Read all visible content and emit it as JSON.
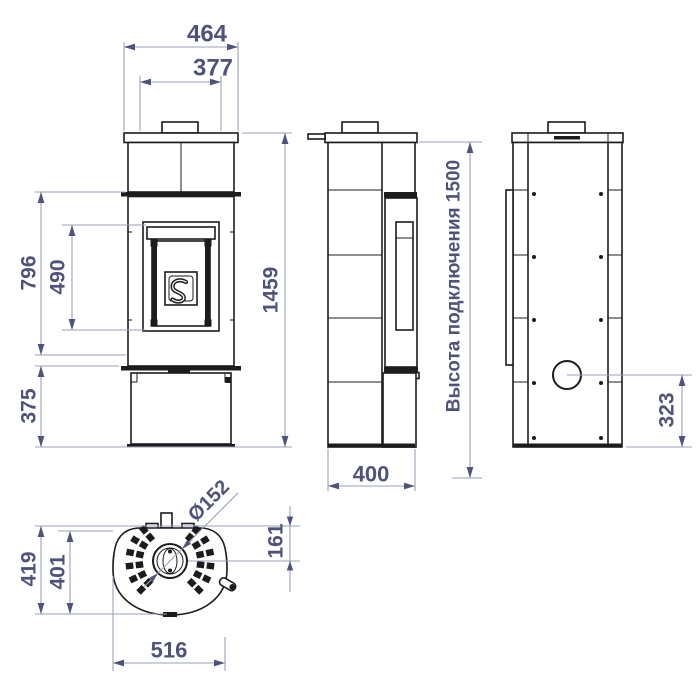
{
  "labels": {
    "front_top_plate_width": "464",
    "front_body_width": "377",
    "front_firebox_height": "796",
    "front_door_height": "490",
    "front_base_height": "375",
    "front_total_height": "1459",
    "side_depth": "400",
    "side_connection_height": "Высота подключения 1500",
    "back_flue_center_height": "323",
    "top_depth_total": "419",
    "top_depth_inner": "401",
    "top_width": "516",
    "top_flue_diameter": "Ø152",
    "top_flue_offset": "161"
  },
  "colors": {
    "outline": "#1c1c1c",
    "dimension_text": "#4f5379",
    "dimension_line": "#9aa2ba",
    "background": "#ffffff"
  }
}
